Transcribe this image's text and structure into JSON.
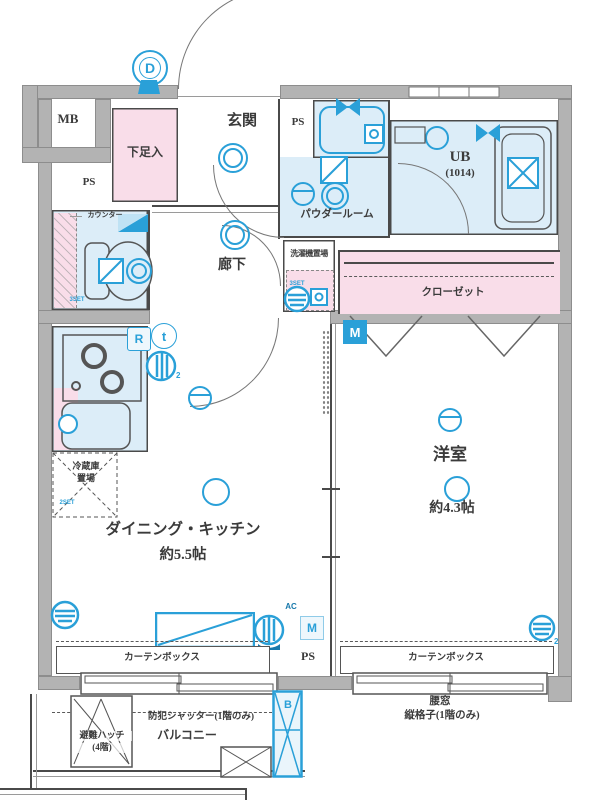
{
  "labels": {
    "mb": "MB",
    "ps": "PS",
    "genkan": "玄関",
    "shoe": "下足入",
    "powder": "パウダールーム",
    "ub": "UB",
    "ub_size": "(1014)",
    "laundry": "洗濯機置場",
    "closet": "クローゼット",
    "counter": "カウンター",
    "hallway": "廊下",
    "fridge1": "冷蔵庫",
    "fridge2": "置場",
    "dk": "ダイニング・キッチン",
    "dk_size": "約5.5帖",
    "western": "洋室",
    "western_size": "約4.3帖",
    "curtain": "カーテンボックス",
    "balcony": "バルコニー",
    "shutter": "防犯シャッター(1階のみ)",
    "hatch1": "避難ハッチ",
    "hatch2": "(4階)",
    "koshimado": "腰窓",
    "lattice": "縦格子(1階のみ)",
    "ac": "AC",
    "set3": "3SET",
    "set2": "2SET"
  },
  "badges": {
    "d": "D",
    "m": "M",
    "b": "B",
    "r": "R",
    "t": "t",
    "sub2": "2"
  },
  "colors": {
    "wall": "#b3b3b3",
    "room_blue": "#dcedf8",
    "room_pink": "#f9dde9",
    "accent": "#2aa0d8",
    "line": "#4a4a4a"
  }
}
